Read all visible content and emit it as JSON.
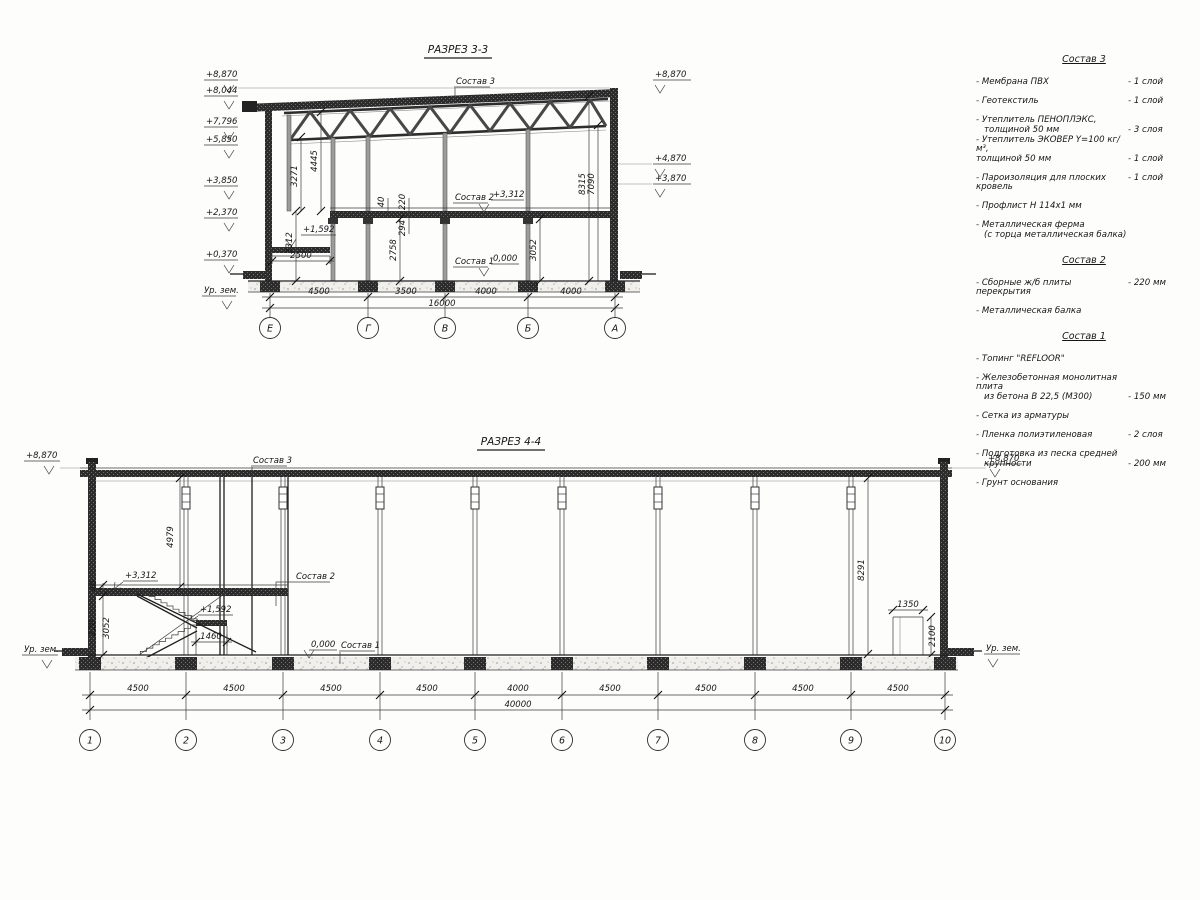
{
  "sheet": {
    "background": "#fdfdfc",
    "ink": "#161616"
  },
  "section33": {
    "title": "РАЗРЕЗ 3-3",
    "callouts": {
      "s3": "Состав 3",
      "s2": "Состав 2",
      "s1": "Состав 1",
      "lvl3312": "+3,312",
      "lvl1592": "+1,592",
      "lvl0": "0,000"
    },
    "elev_left": [
      "+8,870",
      "+8,044",
      "+7,796",
      "+5,850",
      "+3,850",
      "+2,370",
      "+0,370"
    ],
    "elev_right": [
      "+8,870",
      "+4,870",
      "+3,870"
    ],
    "ground": "Ур. зем.",
    "dims": {
      "v3271": "3271",
      "v4445": "4445",
      "v3312": "3312",
      "h2500": "2500",
      "t40": "40",
      "t220": "220",
      "t294": "294",
      "v2758": "2758",
      "v3052": "3052",
      "v8315": "8315",
      "v7090": "7090"
    },
    "bottom_dims": [
      "4500",
      "3500",
      "4000",
      "4000"
    ],
    "total": "16000",
    "axes": [
      "Е",
      "Г",
      "В",
      "Б",
      "А"
    ]
  },
  "section44": {
    "title": "РАЗРЕЗ 4-4",
    "callouts": {
      "s3": "Состав 3",
      "s2": "Состав 2",
      "s1": "Состав 1",
      "lvl3312": "+3,312",
      "lvl1592": "+1,592",
      "lvl0": "0,000"
    },
    "elev_left": "+8,870",
    "elev_right": "+8,870",
    "ground_left": "Ур. зем.",
    "ground_right": "Ур. зем.",
    "dims": {
      "v4979": "4979",
      "t40": "40",
      "t220": "220",
      "v3052": "3052",
      "v8291": "8291",
      "h1460": "1460",
      "h1350": "1350",
      "v2100": "2100"
    },
    "bottom_dims": [
      "4500",
      "4500",
      "4500",
      "4500",
      "4000",
      "4500",
      "4500",
      "4500",
      "4500"
    ],
    "total": "40000",
    "axes": [
      "1",
      "2",
      "3",
      "4",
      "5",
      "6",
      "7",
      "8",
      "9",
      "10"
    ]
  },
  "legend": {
    "groups": [
      {
        "title": "Состав 3",
        "rows": [
          {
            "label": "- Мембрана ПВХ",
            "value": "- 1 слой"
          },
          {
            "label": "- Геотекстиль",
            "value": "- 1 слой"
          },
          {
            "label": "- Утеплитель ПЕНОПЛЭКС,",
            "value": ""
          },
          {
            "label": "толщиной 50 мм",
            "value": "- 3 слоя"
          },
          {
            "label": "- Утеплитель ЭКОВЕР Y=100 кг/м³,",
            "value": ""
          },
          {
            "label": "толщиной 50 мм",
            "value": "- 1 слой"
          },
          {
            "label": "- Пароизоляция для плоских кровель",
            "value": "- 1 слой"
          },
          {
            "label": "- Профлист Н 114х1 мм",
            "value": ""
          },
          {
            "label": "- Металлическая ферма",
            "value": ""
          },
          {
            "label": "(с торца металлическая балка)",
            "value": ""
          }
        ]
      },
      {
        "title": "Состав 2",
        "rows": [
          {
            "label": "- Сборные ж/б плиты перекрытия",
            "value": "- 220 мм"
          },
          {
            "label": "- Металлическая балка",
            "value": ""
          }
        ]
      },
      {
        "title": "Состав 1",
        "rows": [
          {
            "label": "- Топинг \"REFLOOR\"",
            "value": ""
          },
          {
            "label": "- Железобетонная  монолитная плита",
            "value": ""
          },
          {
            "label": "из бетона В 22,5 (М300)",
            "value": "- 150 мм"
          },
          {
            "label": "- Сетка из арматуры",
            "value": ""
          },
          {
            "label": "- Пленка полиэтиленовая",
            "value": "- 2 слоя"
          },
          {
            "label": "- Подготовка из песка средней",
            "value": ""
          },
          {
            "label": "крупности",
            "value": "- 200 мм"
          },
          {
            "label": "- Грунт основания",
            "value": ""
          }
        ]
      }
    ]
  }
}
